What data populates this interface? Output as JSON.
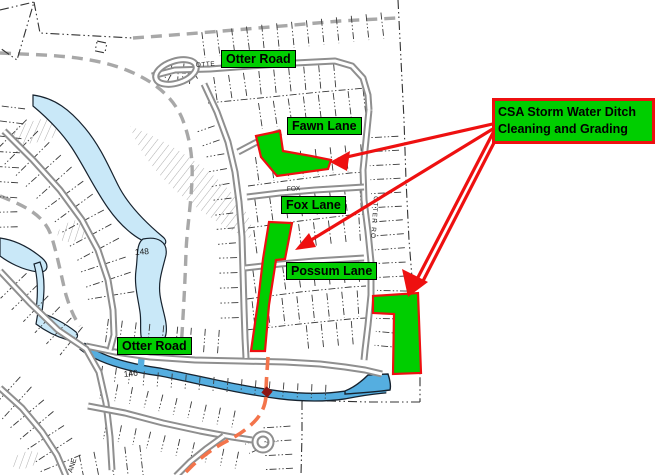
{
  "labels": {
    "otter_road_top": "Otter Road",
    "fawn_lane": "Fawn Lane",
    "fox_lane": "Fox Lane",
    "possum_lane": "Possum Lane",
    "otter_road_bottom": "Otter Road"
  },
  "callout": {
    "line1": "CSA Storm Water Ditch",
    "line2": "Cleaning and Grading"
  },
  "map_texts": {
    "street_top": "OTTE",
    "street_fox": "FOX",
    "street_otter_vertical": "OTTER RO",
    "pond_number": "148",
    "creek_number": "146",
    "lane_partial": "ANE"
  },
  "colors": {
    "highlight_green": "#00CE00",
    "label_green": "#00CE00",
    "annotation_red": "#EE1010",
    "road_gray": "#8F8F8F",
    "boundary_gray": "#A8A8A8",
    "parcel_line": "#3A3A3A",
    "pond_fill": "#C9E8F8",
    "creek_fill": "#55AEE0",
    "water_outline": "#16222E",
    "survey_orange": "#F3744B",
    "background": "#FFFFFF",
    "text_black": "#000000"
  }
}
